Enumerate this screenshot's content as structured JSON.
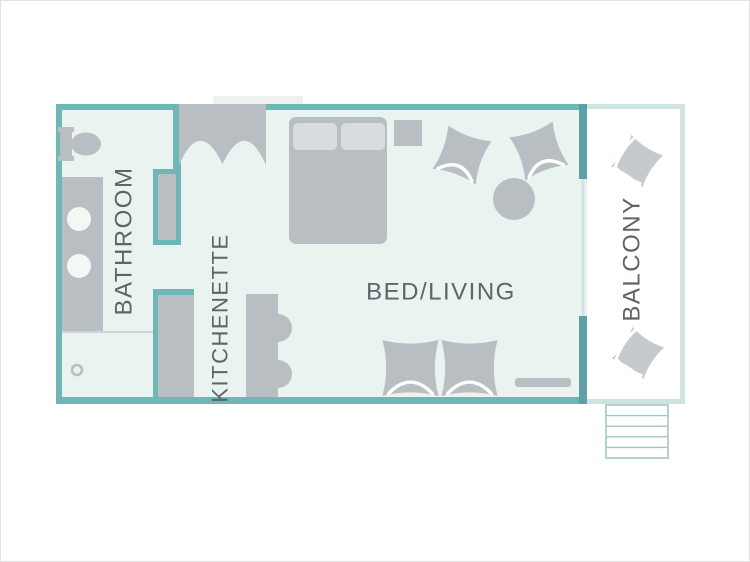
{
  "rooms": {
    "bathroom": {
      "label": "BATHROOM"
    },
    "kitchenette": {
      "label": "KITCHENETTE"
    },
    "bed_living": {
      "label": "BED/LIVING"
    },
    "balcony": {
      "label": "BALCONY"
    }
  },
  "colors": {
    "wall": "#6fb7b5",
    "wall_dark": "#5fa0a6",
    "floor": "#e9f4f1",
    "balcony_border": "#cfe4e2",
    "furniture": "#b9bec3",
    "furniture_light": "#c6cacd",
    "pillow_gray": "#d9dcde",
    "sink": "#f2f8f6",
    "landing": "#eff1f1",
    "divider": "#d0d4d6",
    "stairs": "#a3c6c4",
    "label": "#5e6467"
  }
}
